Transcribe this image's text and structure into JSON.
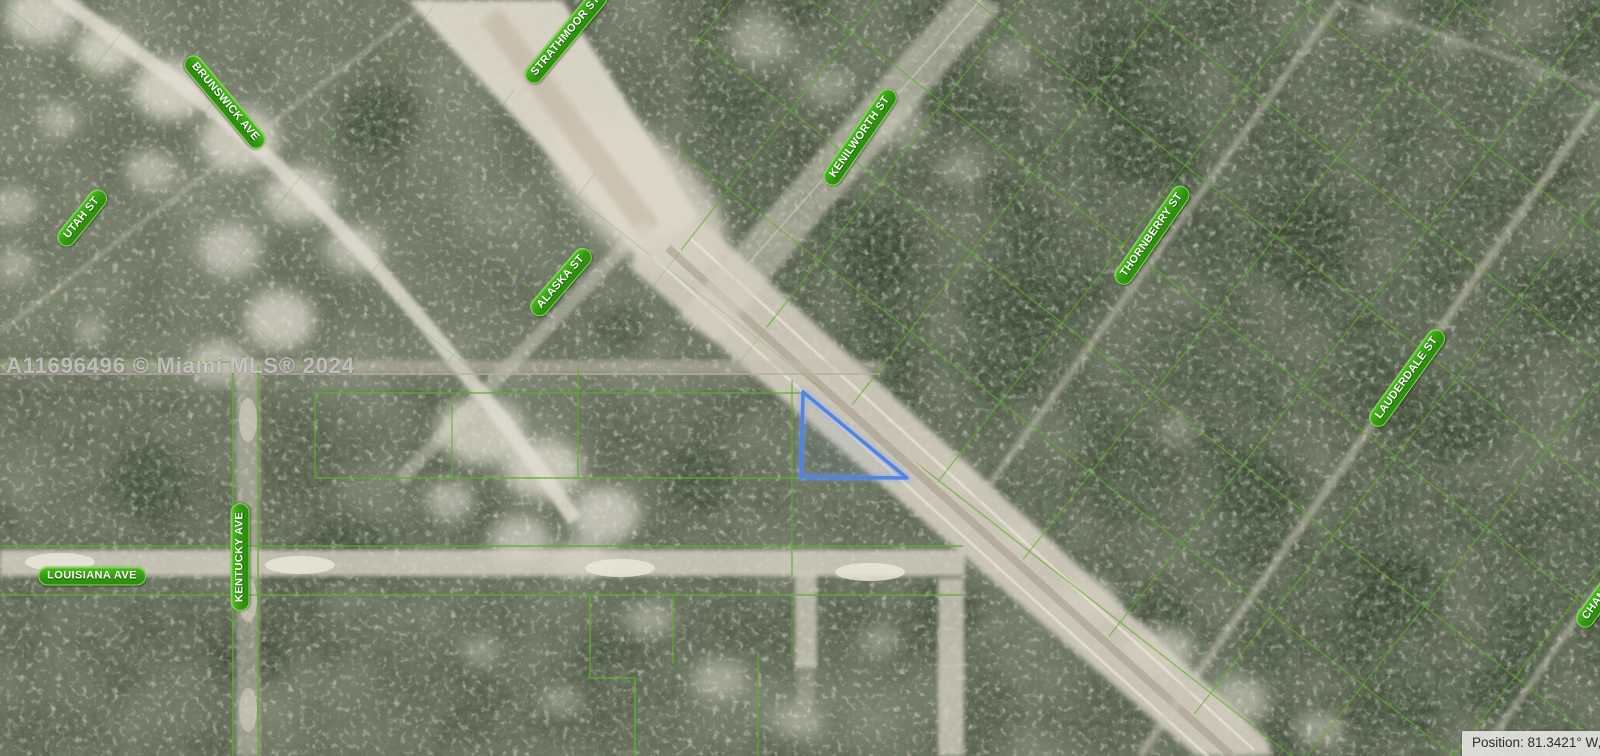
{
  "map": {
    "type": "aerial-satellite-parcel-map",
    "street_labels": [
      {
        "name": "brunswick-ave",
        "text": "BRUNSWICK AVE"
      },
      {
        "name": "utah-st",
        "text": "UTAH ST"
      },
      {
        "name": "strathmoor-st",
        "text": "STRATHMOOR ST"
      },
      {
        "name": "alaska-st",
        "text": "ALASKA ST"
      },
      {
        "name": "kenilworth-st",
        "text": "KENILWORTH ST"
      },
      {
        "name": "thornberry-st",
        "text": "THORNBERRY ST"
      },
      {
        "name": "lauderdale-st",
        "text": "LAUDERDALE ST"
      },
      {
        "name": "chamberlain-st-clipped",
        "text": "CHAMBE"
      },
      {
        "name": "kentucky-ave",
        "text": "KENTUCKY AVE"
      },
      {
        "name": "louisiana-ave",
        "text": "LOUISIANA AVE"
      }
    ],
    "colors": {
      "label_pill_green": "#33990f",
      "label_border": "#86d957",
      "parcel_line_green": "#5fae2e",
      "highlight_parcel_blue": "#4e84e6",
      "sand_road": "#ddd8ca",
      "vegetation_dark": "#4c5542"
    },
    "highlight_parcel": {
      "shape": "right-triangle",
      "outline": "#4e84e6"
    }
  },
  "watermark": {
    "text": "A11696496 © Miami MLS® 2024"
  },
  "status_bar": {
    "position_text": "Position: 81.3421° W, 2"
  }
}
